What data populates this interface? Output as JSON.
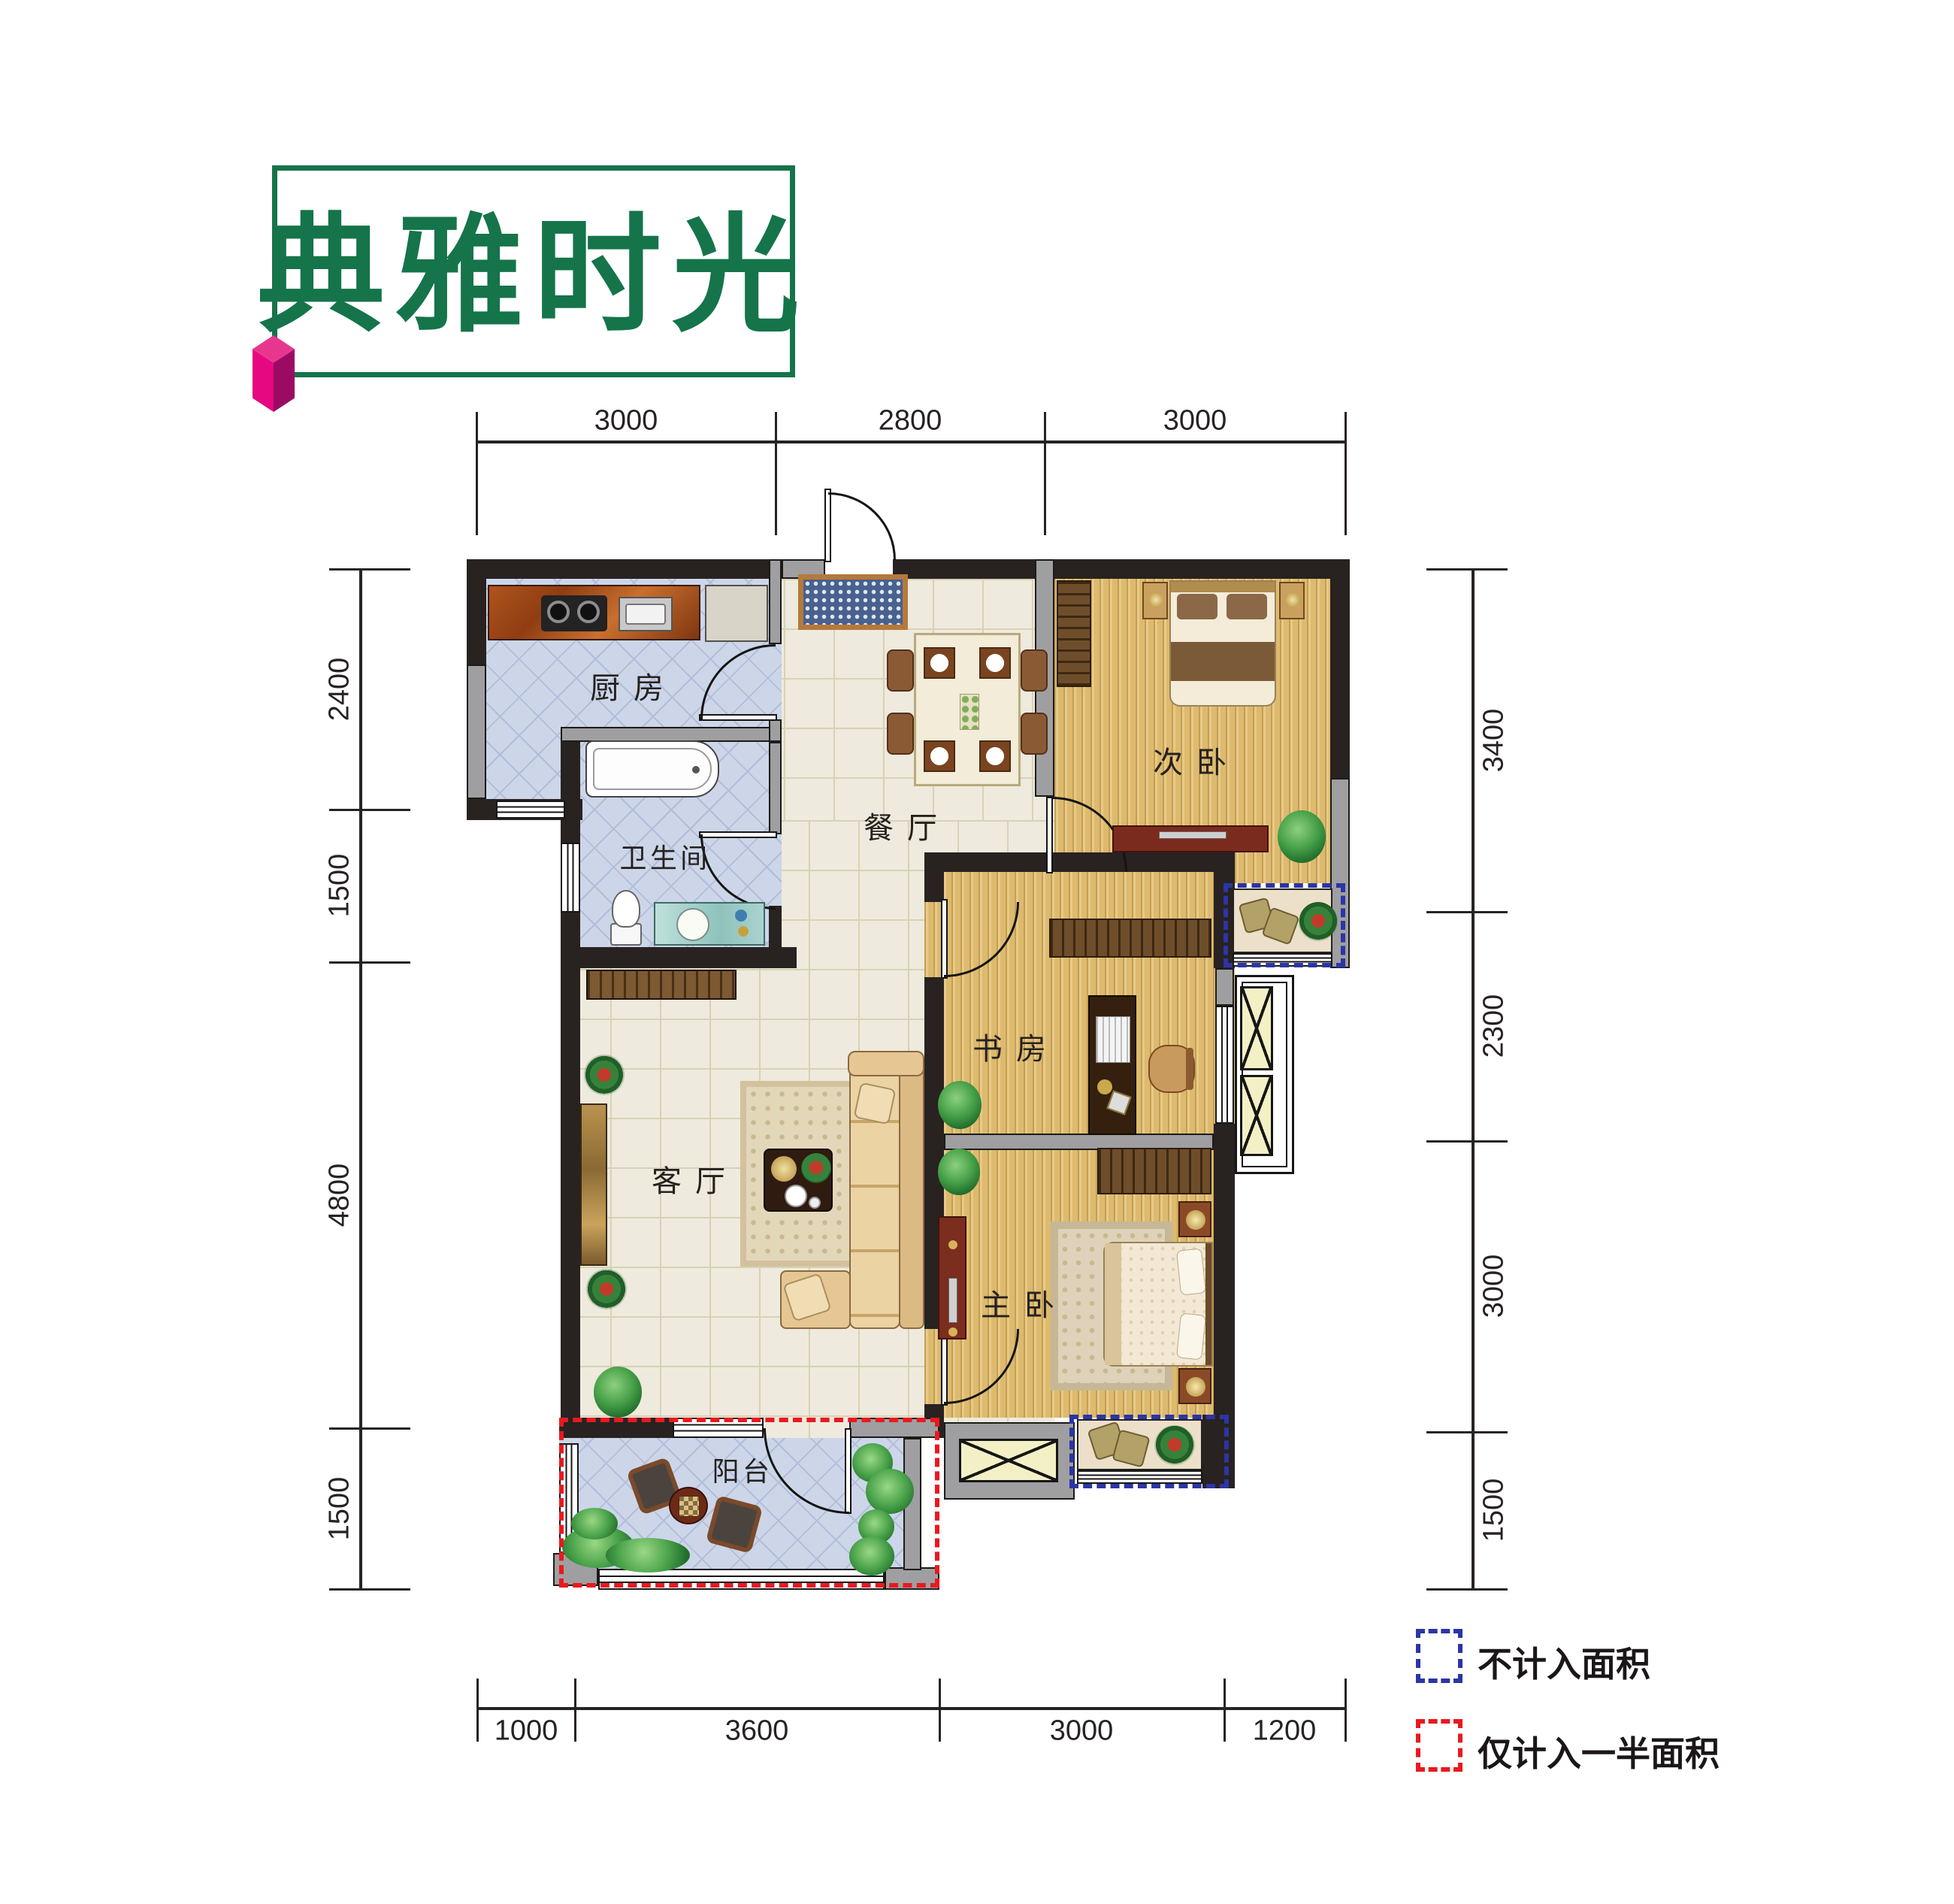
{
  "title": {
    "text": "典雅时光"
  },
  "rooms": {
    "kitchen": {
      "label": "厨房"
    },
    "bathroom": {
      "label": "卫生间"
    },
    "dining": {
      "label": "餐厅"
    },
    "secondary_bedroom": {
      "label": "次卧"
    },
    "study": {
      "label": "书房"
    },
    "living": {
      "label": "客厅"
    },
    "master_bedroom": {
      "label": "主卧"
    },
    "balcony": {
      "label": "阳台"
    }
  },
  "dimensions": {
    "top": [
      "3000",
      "2800",
      "3000"
    ],
    "bottom": [
      "1000",
      "3600",
      "3000",
      "1200"
    ],
    "left": [
      "2400",
      "1500",
      "4800",
      "1500"
    ],
    "right": [
      "3400",
      "2300",
      "3000",
      "1500"
    ]
  },
  "legend": {
    "items": [
      {
        "label": "不计入面积",
        "color": "#2b35a5"
      },
      {
        "label": "仅计入一半面积",
        "color": "#e9191f"
      }
    ]
  },
  "colors": {
    "accent_green": "#15744a",
    "logo_magenta": "#e50880",
    "excluded_dash_blue": "#2b35a5",
    "half_area_dash_red": "#e9191f",
    "dark_wall": "#282221",
    "gray_wall": "#9f9fa1"
  }
}
